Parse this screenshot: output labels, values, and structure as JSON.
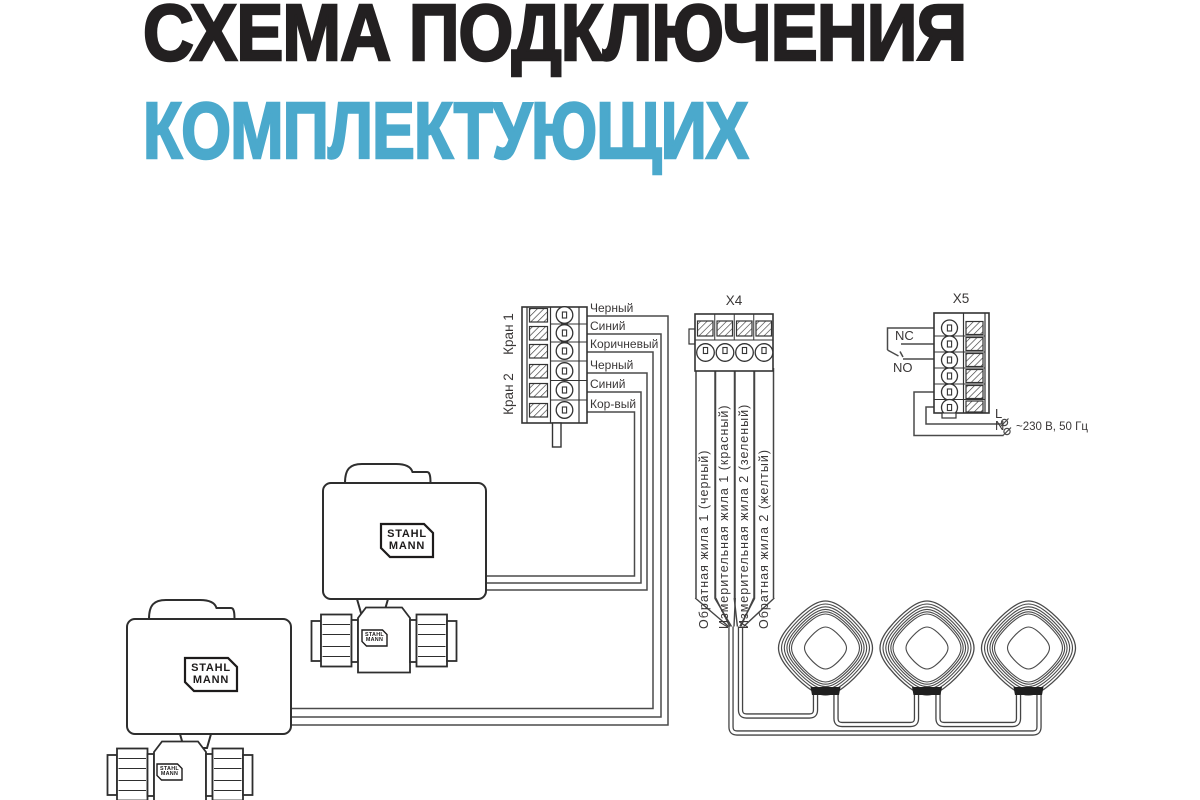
{
  "title": {
    "line1": "СХЕМА ПОДКЛЮЧЕНИЯ",
    "line2": "КОМПЛЕКТУЮЩИХ"
  },
  "colors": {
    "ink": "#232021",
    "accent": "#4BA9CC",
    "line": "#3d3d3d"
  },
  "left_block": {
    "group1": "Кран 1",
    "group2": "Кран 2",
    "wires": [
      {
        "label": "Черный"
      },
      {
        "label": "Синий"
      },
      {
        "label": "Коричневый"
      },
      {
        "label": "Черный"
      },
      {
        "label": "Синий"
      },
      {
        "label": "Кор-вый"
      }
    ]
  },
  "x4_block": {
    "title": "X4",
    "wires": [
      {
        "label": "Обратная жила 1 (черный)"
      },
      {
        "label": "Измерительная жила 1 (красный)"
      },
      {
        "label": "Измерительная жила 2 (зеленый)"
      },
      {
        "label": "Обратная жила 2 (желтый)"
      }
    ]
  },
  "x5_block": {
    "title": "X5",
    "nc": "NC",
    "no": "NO",
    "l": "L",
    "n": "N",
    "power": "~230 В, 50 Гц"
  },
  "brand": {
    "line1": "STAHL",
    "line2": "MANN"
  }
}
